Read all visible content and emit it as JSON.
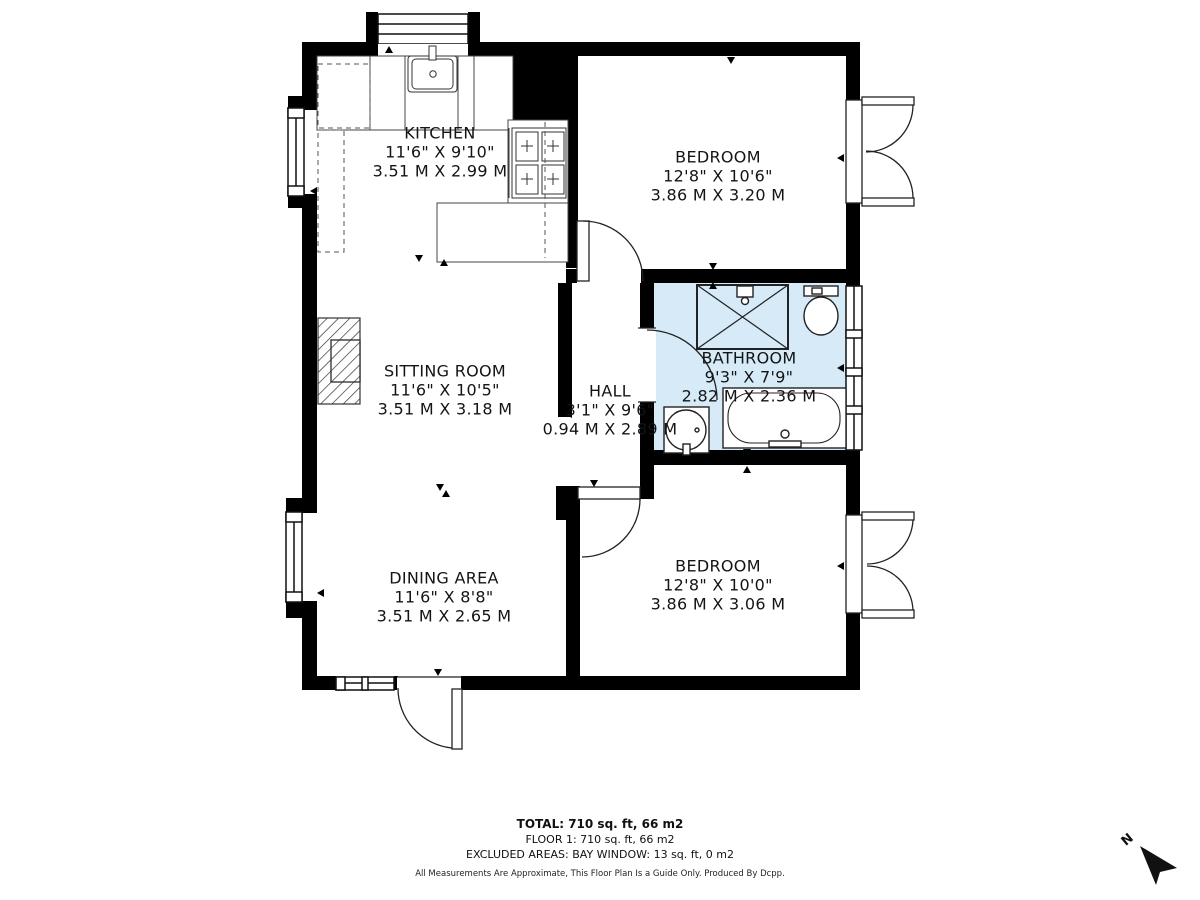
{
  "plan": {
    "rooms": [
      {
        "name": "KITCHEN",
        "dims_ft": "11'6\" X 9'10\"",
        "dims_m": "3.51 M X 2.99 M"
      },
      {
        "name": "BEDROOM",
        "dims_ft": "12'8\" X 10'6\"",
        "dims_m": "3.86 M X 3.20 M"
      },
      {
        "name": "SITTING ROOM",
        "dims_ft": "11'6\" X 10'5\"",
        "dims_m": "3.51 M X 3.18 M"
      },
      {
        "name": "BATHROOM",
        "dims_ft": "9'3\" X 7'9\"",
        "dims_m": "2.82 M X 2.36 M"
      },
      {
        "name": "HALL",
        "dims_ft": "3'1\" X 9'6\"",
        "dims_m": "0.94 M X 2.89 M"
      },
      {
        "name": "DINING AREA",
        "dims_ft": "11'6\" X 8'8\"",
        "dims_m": "3.51 M X 2.65 M"
      },
      {
        "name": "BEDROOM",
        "dims_ft": "12'8\" X 10'0\"",
        "dims_m": "3.86 M X 3.06 M"
      }
    ],
    "bathroom_fill": "#d6eaf8",
    "wall_color": "#000000"
  },
  "footer": {
    "total": "TOTAL: 710 sq. ft, 66 m2",
    "floor": "FLOOR 1: 710 sq. ft, 66 m2",
    "excluded": "EXCLUDED AREAS: BAY WINDOW: 13 sq. ft, 0 m2",
    "disclaimer": "All Measurements Are Approximate, This Floor Plan Is a Guide Only. Produced By Dcpp."
  },
  "compass": {
    "north_label": "N"
  }
}
